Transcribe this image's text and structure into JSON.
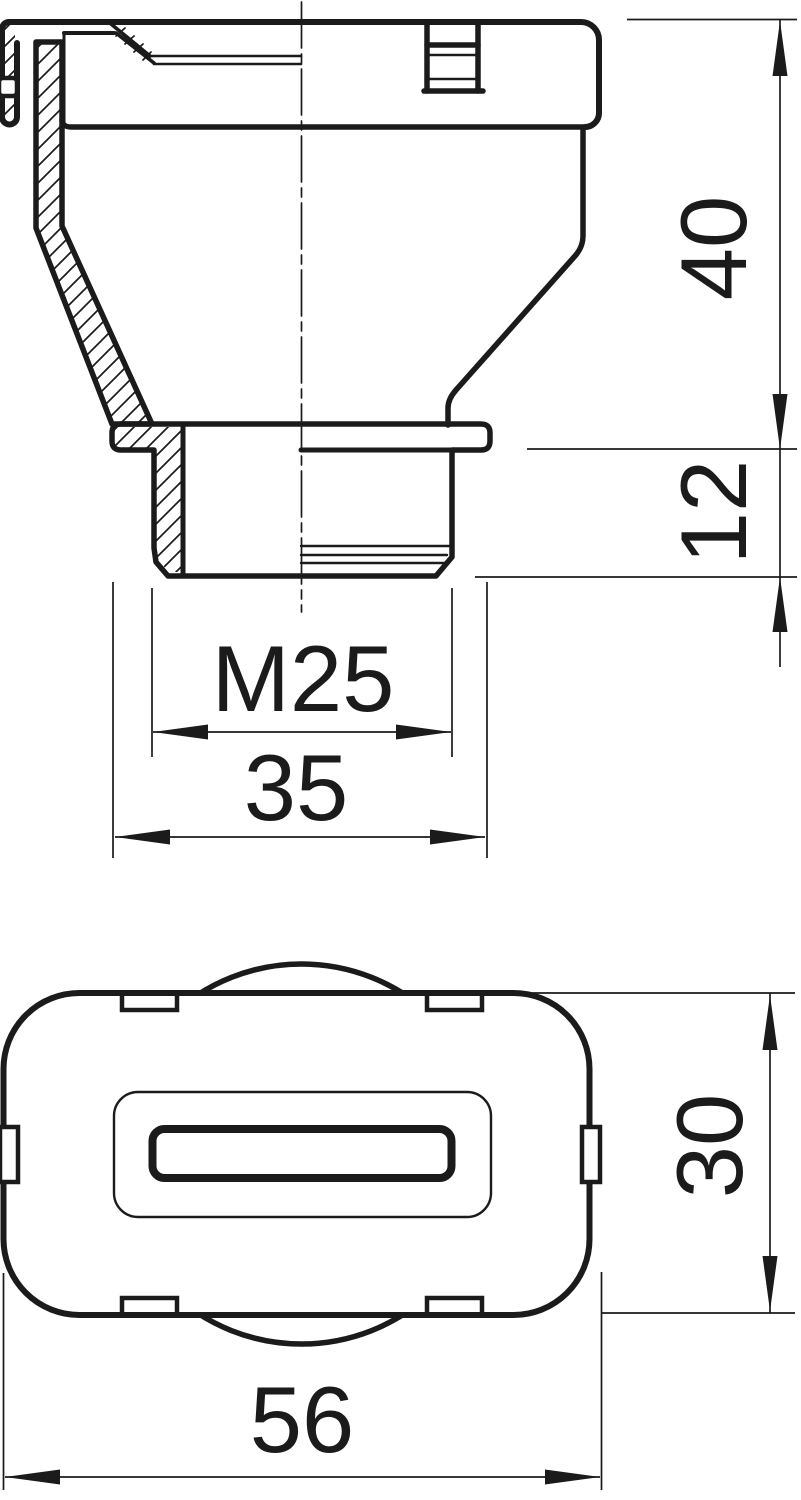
{
  "drawing": {
    "title": "cable-gland-technical-drawing",
    "ink_color": "#1b1b1b",
    "background_color": "#ffffff",
    "views": {
      "side_section": "side-section-view",
      "bottom": "bottom-view"
    },
    "dims": {
      "upper_height": "40",
      "thread_length": "12",
      "thread_size": "M25",
      "flange_diameter": "35",
      "body_depth": "30",
      "body_width": "56"
    }
  }
}
